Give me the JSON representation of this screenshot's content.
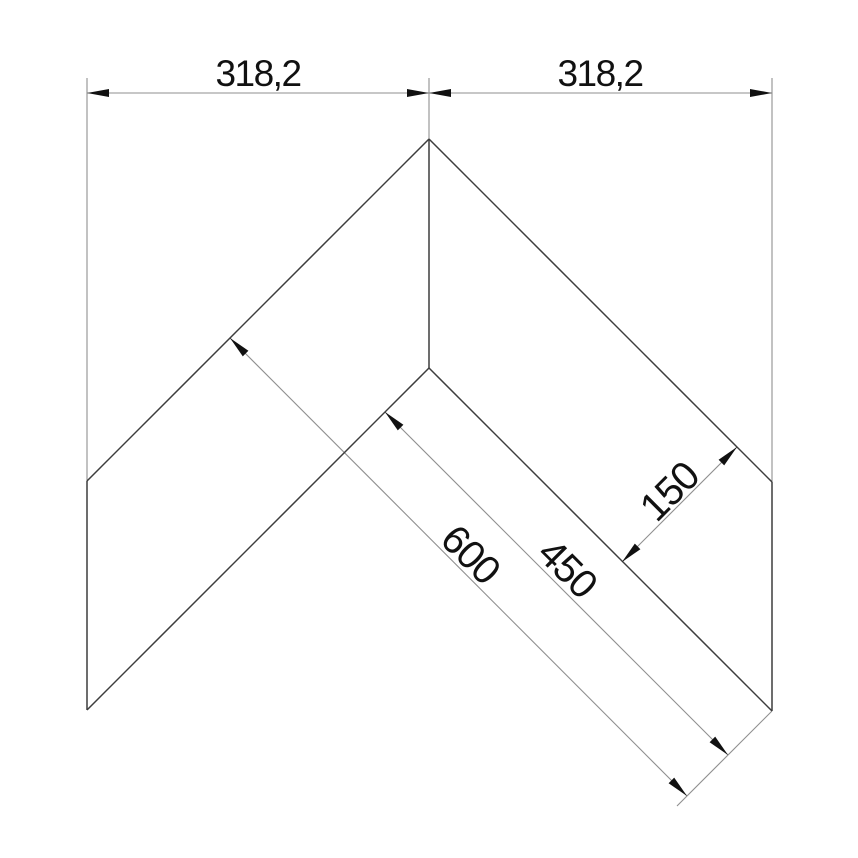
{
  "drawing": {
    "type": "technical-dimension-drawing",
    "subject": "v-shaped corner panel flat pattern",
    "colors": {
      "background": "#ffffff",
      "shape_edges": "#3d3d3d",
      "dimension_lines": "#8f8f8f",
      "arrowheads": "#111111",
      "text": "#111111"
    },
    "dimensions": {
      "top_left_span": "318,2",
      "top_right_span": "318,2",
      "outer_diagonal_length": "600",
      "inner_diagonal_length": "450",
      "panel_width": "150"
    }
  }
}
